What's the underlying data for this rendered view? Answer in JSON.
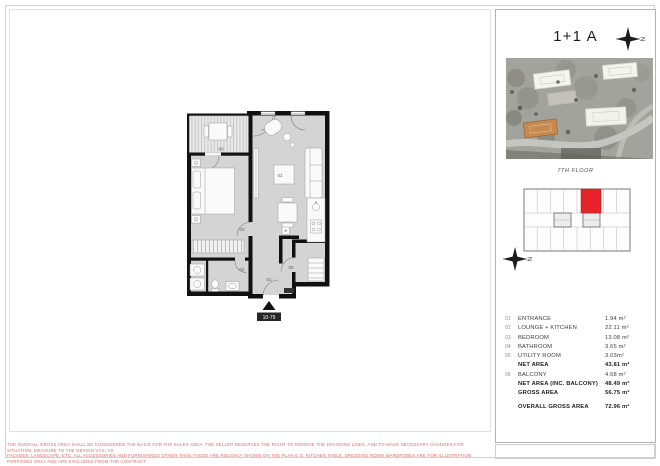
{
  "header": {
    "title": "1+1 A"
  },
  "site_section": {
    "floor_label": "7TH FLOOR"
  },
  "plan": {
    "unit_badge": "10-79",
    "room_labels": {
      "entrance": "01",
      "lounge_kitchen": "02",
      "bedroom": "03",
      "bathroom": "04",
      "utility": "05",
      "balcony": "06"
    }
  },
  "compass": {
    "north": "N"
  },
  "area_table": {
    "rows": [
      {
        "no": "01",
        "label": "ENTRANCE",
        "value": "1.94 m²",
        "bold": false,
        "spaced": false
      },
      {
        "no": "02",
        "label": "LOUNGE + KITCHEN",
        "value": "22.11 m²",
        "bold": false,
        "spaced": false
      },
      {
        "no": "03",
        "label": "BEDROOM",
        "value": "13.08 m²",
        "bold": false,
        "spaced": false
      },
      {
        "no": "04",
        "label": "BATHROOM",
        "value": "3.65 m²",
        "bold": false,
        "spaced": false
      },
      {
        "no": "05",
        "label": "UTILITY ROOM",
        "value": "3.03m²",
        "bold": false,
        "spaced": false
      },
      {
        "no": "",
        "label": "NET AREA",
        "value": "43.81 m²",
        "bold": true,
        "spaced": false
      },
      {
        "no": "06",
        "label": "BALCONY",
        "value": "4.68 m²",
        "bold": false,
        "spaced": false
      },
      {
        "no": "",
        "label": "NET AREA (INC. BALCONY)",
        "value": "48.49 m²",
        "bold": true,
        "spaced": false
      },
      {
        "no": "",
        "label": "GROSS AREA",
        "value": "56.75 m²",
        "bold": true,
        "spaced": false
      },
      {
        "no": "",
        "label": "OVERALL GROSS AREA",
        "value": "72.96 m²",
        "bold": true,
        "spaced": true
      }
    ]
  },
  "disclaimer": {
    "line1": "THE OVERALL GROSS AREA SHALL BE CONSIDERED THE BASIS FOR THE SALES AREA. THE SELLER RESERVES THE RIGHT TO REMOVE THE DIVISIONS LINES, AND TO MAKE NECESSARY CHANGES FOR SITUATION, MEASURE TO THE DESIGN VCS, VS",
    "line2": "FACADES, LANDSCAPE, ETC. ALL ACCESSORIES AND FURNISHINGS OTHER THAN THOSE ARE ROUGHLY SHOWN ON THE PLAN E.G. KITCHEN TABLE, DRESSING ROOM WARDROBES ARE FOR ILLUSTRATION PURPOSES ONLY AND ARE EXCLUDED FROM THE CONTRACT"
  },
  "colors": {
    "unit_highlight_red": "#e5252a",
    "site_building_orange": "#c6894f",
    "wall_black": "#111111",
    "floor_gray": "#d4d4d4",
    "disclaimer_red": "#d96a6a"
  }
}
